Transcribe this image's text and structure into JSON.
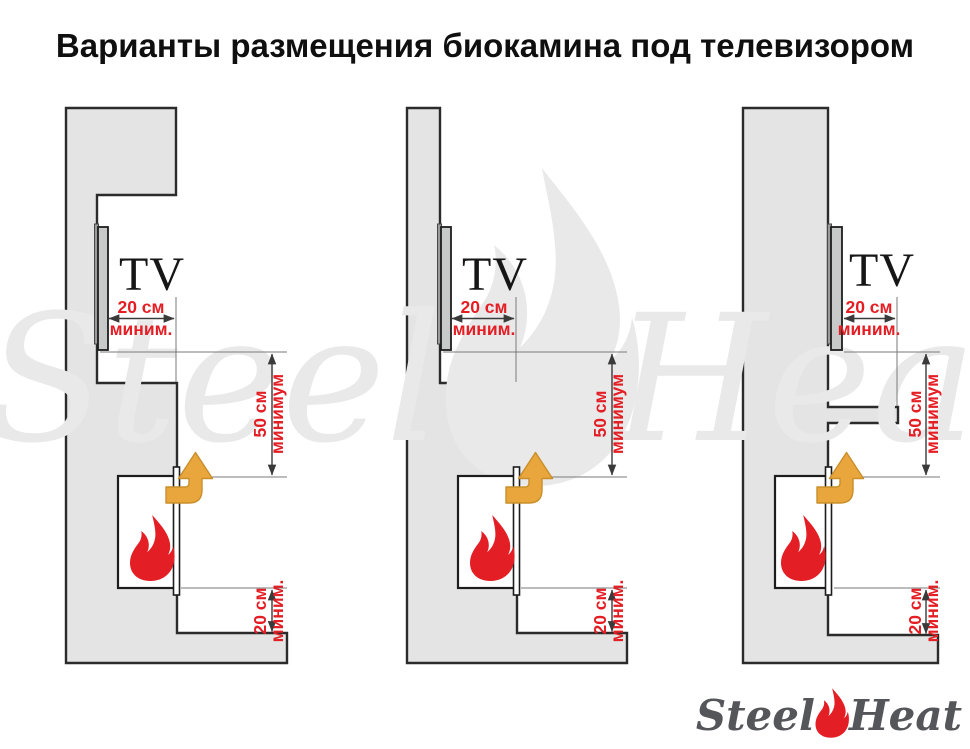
{
  "title": "Варианты размещения биокамина под телевизором",
  "diagrams": [
    {
      "tv_label": "TV",
      "dims": {
        "top": [
          "20 см",
          "миним."
        ],
        "mid": [
          "50 см",
          "минимум"
        ],
        "bottom": [
          "20 см",
          "миним."
        ]
      }
    },
    {
      "tv_label": "TV",
      "dims": {
        "top": [
          "20 см",
          "миним."
        ],
        "mid": [
          "50 см",
          "минимум"
        ],
        "bottom": [
          "20 см",
          "миним."
        ]
      }
    },
    {
      "tv_label": "TV",
      "dims": {
        "top": [
          "20 см",
          "миним."
        ],
        "mid": [
          "50 см",
          "минимум"
        ],
        "bottom": [
          "20 см",
          "миним."
        ]
      }
    }
  ],
  "watermark": {
    "word_left": "Steel",
    "word_right": "Heat"
  },
  "logo": {
    "word_left": "Steel",
    "word_right": "Heat"
  },
  "icons": {
    "flame": "flame-icon",
    "vent_arrow": "vent-arrow-icon"
  },
  "colors": {
    "wall_gray": "#e3e4e3",
    "outline": "#2b2b2b",
    "accent_red": "#e31e24",
    "arrow_orange": "#e8a63c",
    "arrow_orange_dark": "#c98f2b",
    "tv_gray": "#c8cac9",
    "bracket_gray": "#9b9b9b",
    "dim_line": "#3a3a3a",
    "ext_line": "#7a7a7a",
    "logo_gray": "#55565a",
    "watermark_gray": "#e9e9e9",
    "title_black": "#0f0f0f",
    "fireplace_white": "#ffffff"
  }
}
